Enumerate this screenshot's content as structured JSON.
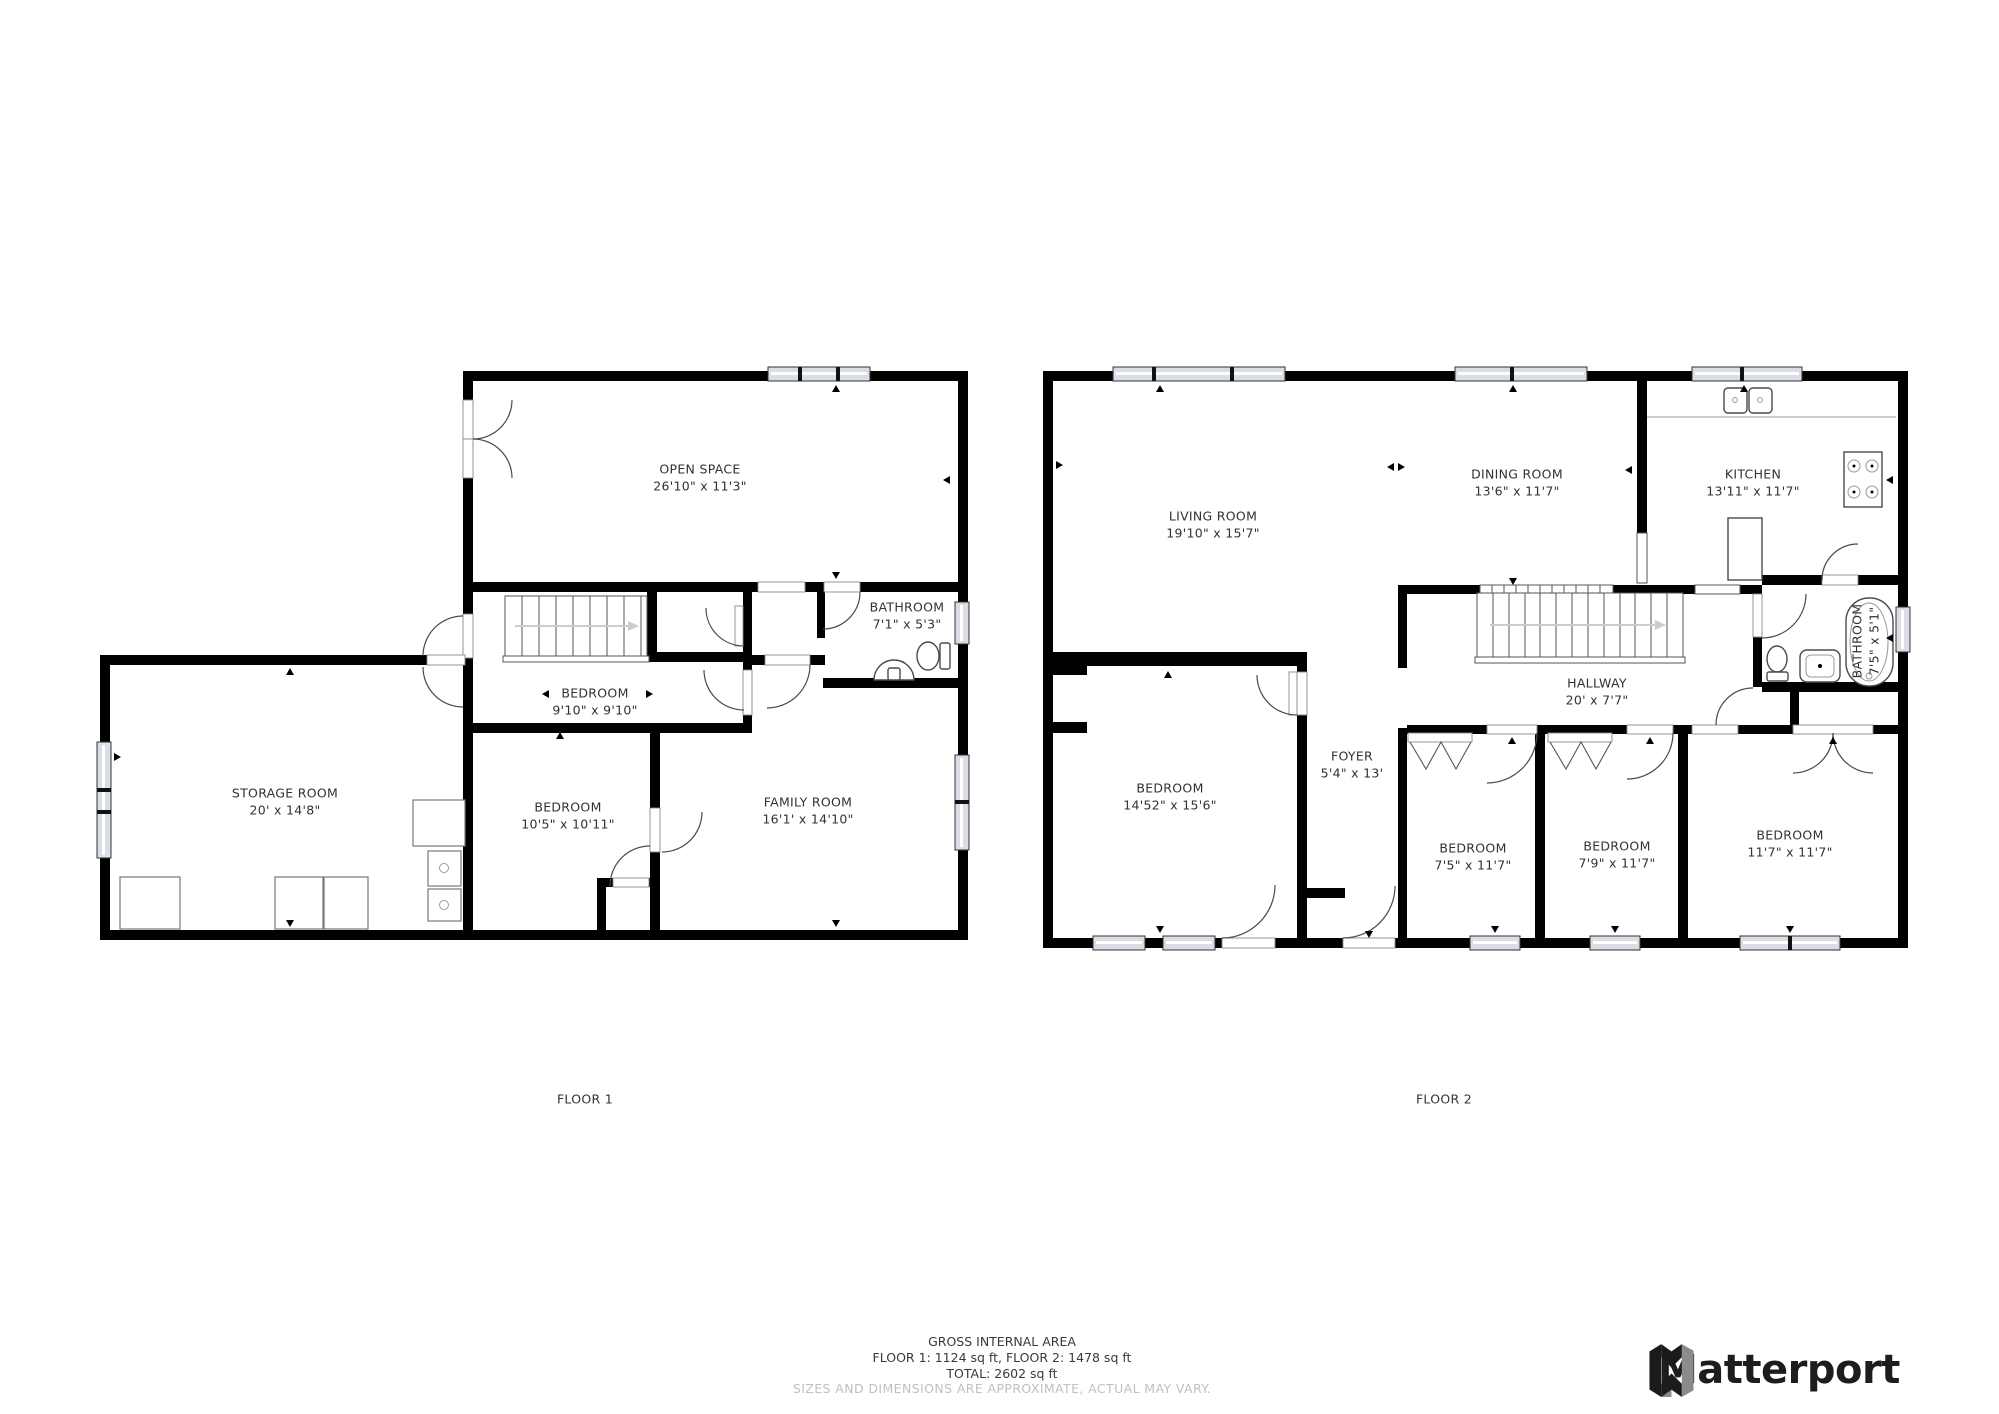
{
  "floor1": {
    "label": "FLOOR 1",
    "rooms": {
      "open_space": {
        "name": "OPEN SPACE",
        "dims": "26'10\" x 11'3\""
      },
      "bathroom": {
        "name": "BATHROOM",
        "dims": "7'1\" x 5'3\""
      },
      "bedroom_mid": {
        "name": "BEDROOM",
        "dims": "9'10\" x 9'10\""
      },
      "bedroom_low": {
        "name": "BEDROOM",
        "dims": "10'5\" x 10'11\""
      },
      "family_room": {
        "name": "FAMILY ROOM",
        "dims": "16'1' x 14'10\""
      },
      "storage_room": {
        "name": "STORAGE ROOM",
        "dims": "20' x 14'8\""
      }
    }
  },
  "floor2": {
    "label": "FLOOR 2",
    "rooms": {
      "living_room": {
        "name": "LIVING ROOM",
        "dims": "19'10\" x 15'7\""
      },
      "dining_room": {
        "name": "DINING ROOM",
        "dims": "13'6\" x 11'7\""
      },
      "kitchen": {
        "name": "KITCHEN",
        "dims": "13'11\" x 11'7\""
      },
      "hallway": {
        "name": "HALLWAY",
        "dims": "20' x 7'7\""
      },
      "bathroom": {
        "name": "BATHROOM",
        "dims": "7'5\" x 5'1\""
      },
      "bedroom_large": {
        "name": "BEDROOM",
        "dims": "14'52\" x 15'6\""
      },
      "foyer": {
        "name": "FOYER",
        "dims": "5'4\" x 13'"
      },
      "bedroom_1": {
        "name": "BEDROOM",
        "dims": "7'5\" x 11'7\""
      },
      "bedroom_2": {
        "name": "BEDROOM",
        "dims": "7'9\" x 11'7\""
      },
      "bedroom_3": {
        "name": "BEDROOM",
        "dims": "11'7\" x 11'7\""
      }
    }
  },
  "footer": {
    "title": "GROSS INTERNAL AREA",
    "floors_line": "FLOOR 1: 1124 sq ft, FLOOR 2: 1478 sq ft",
    "total_line": "TOTAL: 2602 sq ft",
    "disclaimer": "SIZES AND DIMENSIONS ARE APPROXIMATE, ACTUAL MAY VARY."
  },
  "brand": {
    "logo_text": "Matterport"
  }
}
